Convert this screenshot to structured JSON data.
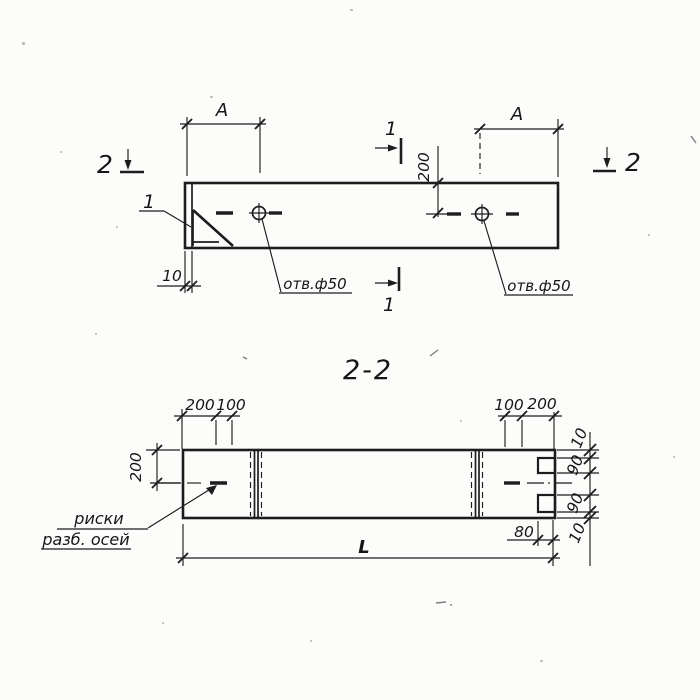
{
  "colors": {
    "paper": "#fcfcfa",
    "ink": "#1d1d1d"
  },
  "views": {
    "plan": {
      "a_left": "A",
      "a_right": "A",
      "v200": "200",
      "d10": "10",
      "hole_left": "отв.ф50",
      "hole_right": "отв.ф50",
      "detail1": "1",
      "s1_top": "1",
      "s1_bot": "1",
      "s2_left": "2",
      "s2_right": "2"
    },
    "section_title": "2-2",
    "section": {
      "tl200": "200",
      "tl100": "100",
      "tr100": "100",
      "tr200": "200",
      "left200": "200",
      "r10a": "10",
      "r90a": "90",
      "r90b": "90",
      "r10b": "10",
      "d80": "80",
      "dL": "L",
      "note1": "риски",
      "note2": "разб. осей"
    }
  }
}
